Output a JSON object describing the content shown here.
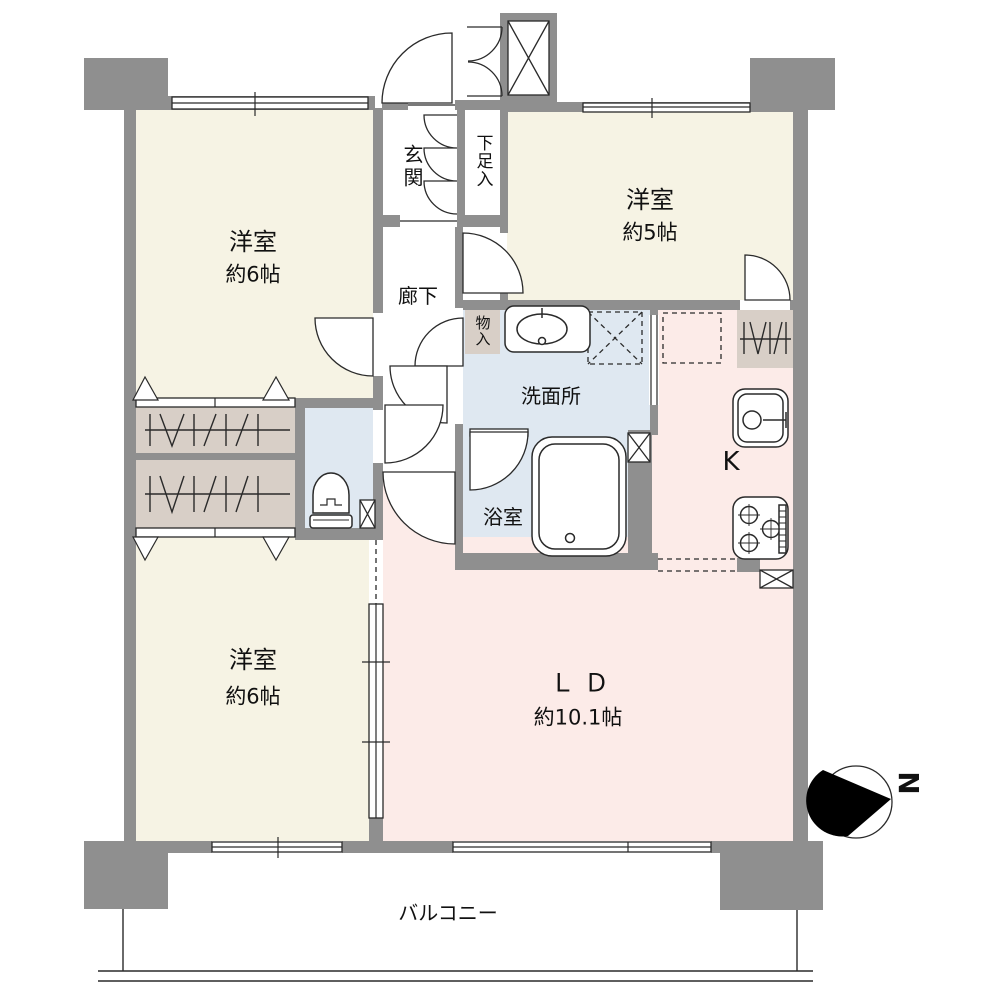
{
  "title": "マンション間取り図 (3LDK floor plan)",
  "rooms": {
    "bedroom_top_left": {
      "label": "洋室",
      "size": "約6帖"
    },
    "bedroom_top_right": {
      "label": "洋室",
      "size": "約5帖"
    },
    "bedroom_bottom_left": {
      "label": "洋室",
      "size": "約6帖"
    },
    "living_dining": {
      "label": "ＬＤ",
      "size": "約10.1帖"
    },
    "kitchen": {
      "label": "K"
    },
    "entrance": {
      "label": "玄関"
    },
    "shoe_cabinet": {
      "label": "下足入"
    },
    "hallway": {
      "label": "廊下"
    },
    "storage": {
      "label": "物入"
    },
    "washroom": {
      "label": "洗面所"
    },
    "bathroom": {
      "label": "浴室"
    },
    "balcony": {
      "label": "バルコニー"
    }
  },
  "compass": {
    "label": "N",
    "direction": "north points right"
  },
  "colors": {
    "wall_gray": "#8f8f8f",
    "room_cream": "#f6f3e4",
    "wet_area_blue": "#dfe8f1",
    "ldk_pink": "#fcebe8",
    "closet_beige": "#d8cfc7",
    "line_black": "#2a2a2a"
  }
}
